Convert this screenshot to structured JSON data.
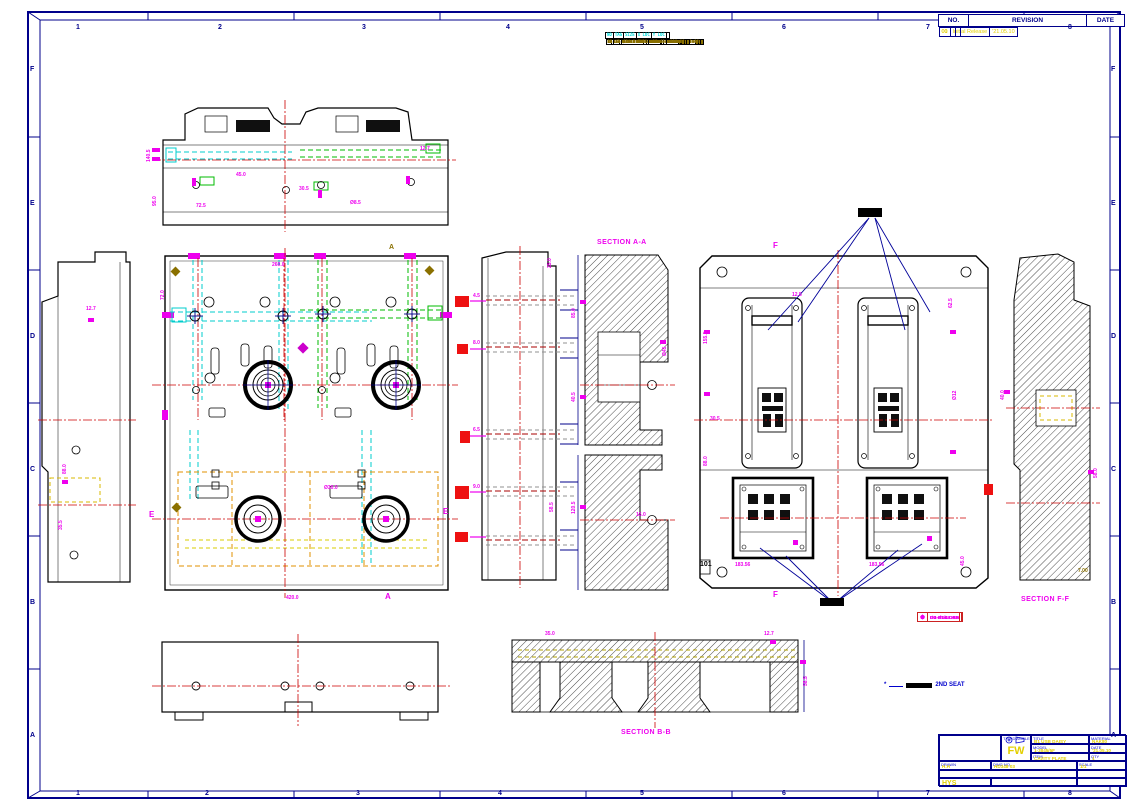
{
  "frame": {
    "top_numbers": [
      {
        "t": "1",
        "x": 76
      },
      {
        "t": "2",
        "x": 218
      },
      {
        "t": "3",
        "x": 362
      },
      {
        "t": "4",
        "x": 506
      },
      {
        "t": "5",
        "x": 640
      },
      {
        "t": "6",
        "x": 782
      },
      {
        "t": "7",
        "x": 926
      },
      {
        "t": "8",
        "x": 1068
      }
    ],
    "bottom_numbers": [
      {
        "t": "1",
        "x": 76
      },
      {
        "t": "2",
        "x": 205
      },
      {
        "t": "3",
        "x": 356
      },
      {
        "t": "4",
        "x": 498
      },
      {
        "t": "5",
        "x": 640
      },
      {
        "t": "6",
        "x": 782
      },
      {
        "t": "7",
        "x": 926
      },
      {
        "t": "8",
        "x": 1068
      }
    ],
    "side_letters": [
      {
        "t": "F",
        "y": 66
      },
      {
        "t": "E",
        "y": 200
      },
      {
        "t": "D",
        "y": 333
      },
      {
        "t": "C",
        "y": 466
      },
      {
        "t": "B",
        "y": 599
      },
      {
        "t": "A",
        "y": 732
      }
    ]
  },
  "hole_table": {
    "headers": [
      "NO",
      "TAG",
      "SIZE",
      "X LOC",
      "Y LOC"
    ],
    "rows": [
      {
        "c1": "1",
        "c2": "A1",
        "c3": "Ø8.5 THRU",
        "c4": "-172.04",
        "c5": "+45.47"
      },
      {
        "c1": "2",
        "c2": "A2",
        "c3": "Ø8.5 THRU",
        "c4": "-97.04",
        "c5": "+45.47"
      },
      {
        "c1": "3",
        "c2": "A3",
        "c3": "Ø8.5 THRU",
        "c4": "-22.04",
        "c5": "+45.47"
      },
      {
        "c1": "4",
        "c2": "A4",
        "c3": "Ø8.5 THRU",
        "c4": "+52.96",
        "c5": "+45.47"
      },
      {
        "c1": "5",
        "c2": "B1",
        "c3": "Ø6.8 DP18",
        "c4": "-160.50",
        "c5": "-22.40"
      },
      {
        "c1": "6",
        "c2": "B2",
        "c3": "Ø6.8 DP18",
        "c4": "-85.50",
        "c5": "-110.88"
      },
      {
        "c1": "7",
        "c2": "B3",
        "c3": "Ø6.8 DP18",
        "c4": "-10.50",
        "c5": "-22.40"
      },
      {
        "c1": "8",
        "c2": "B4",
        "c3": "Ø6.8 DP18",
        "c4": "+64.50",
        "c5": "-110.88"
      },
      {
        "c1": "9",
        "c2": "C1",
        "c3": "Ø10.2 THRU",
        "c4": "-143.00",
        "c5": "+4.12"
      },
      {
        "c1": "10",
        "c2": "C2",
        "c3": "Ø10.2 THRU",
        "c4": "-68.00",
        "c5": "+4.12"
      },
      {
        "c1": "11",
        "c2": "C3",
        "c3": "Ø12.0 DP25",
        "c4": "+7.00",
        "c5": "-64.00"
      },
      {
        "c1": "12",
        "c2": "C4",
        "c3": "Ø12.0 DP25",
        "c4": "+82.00",
        "c5": "-64.00"
      },
      {
        "c1": "13",
        "c2": "D1",
        "c3": "Ø5.1 THRU",
        "c4": "-131.26",
        "c5": "-35.50"
      },
      {
        "c1": "14",
        "c2": "D2",
        "c3": "M12X1.75-6H THRU",
        "c4": "-56.26",
        "c5": "-188.06"
      },
      {
        "c1": "15",
        "c2": "D3",
        "c3": "M12X1.75-6H THRU",
        "c4": "+18.74",
        "c5": "-188.06"
      },
      {
        "c1": "16",
        "c2": "E1",
        "c3": "M10X1.5-6H DP22",
        "c4": "-119.80",
        "c5": "+32.46"
      },
      {
        "c1": "17",
        "c2": "E2",
        "c3": "M10X1.5-6H DP22",
        "c4": "-44.80",
        "c5": "+32.46"
      },
      {
        "c1": "18",
        "c2": "E3",
        "c3": "M10X1.5-6H DP22",
        "c4": "+30.20",
        "c5": "-45.74"
      },
      {
        "c1": "19",
        "c2": "E4",
        "c3": "M10X1.5-6H DP22",
        "c4": "+105.20",
        "c5": "-45.74"
      },
      {
        "c1": "20",
        "c2": "F1",
        "c3": "M8X1.25-6H DP16",
        "c4": "-108.32",
        "c5": "+118.88"
      },
      {
        "c1": "21",
        "c2": "F2",
        "c3": "Ø4.2 DP12",
        "c4": "-33.32",
        "c5": "+54.12"
      },
      {
        "c1": "22",
        "c2": "F3",
        "c3": "Ø4.2 DP12",
        "c4": "+41.68",
        "c5": "+54.12"
      },
      {
        "c1": "23",
        "c2": "G1",
        "c3": "Ø3.5 THRU",
        "c4": "-96.88",
        "c5": "-12.50"
      },
      {
        "c1": "24",
        "c2": "G2",
        "c3": "Ø3.5 THRU",
        "c4": "-21.88",
        "c5": "-12.50"
      },
      {
        "c1": "25",
        "c2": "G3",
        "c3": "Ø3.5 THRU",
        "c4": "+53.12",
        "c5": "-76.24"
      },
      {
        "c1": "26",
        "c2": "H1",
        "c3": "Ø16.0 DP30",
        "c4": "-85.40",
        "c5": "+96.40"
      },
      {
        "c1": "27",
        "c2": "H2",
        "c3": "Ø16.0 DP30",
        "c4": "-10.40",
        "c5": "+96.40"
      },
      {
        "c1": "28",
        "c2": "H3",
        "c3": "Ø16.0 DP30",
        "c4": "+64.60",
        "c5": "-34.20"
      },
      {
        "c1": "29",
        "c2": "J1",
        "c3": "Ø7.0 DP15",
        "c4": "-73.96",
        "c5": "+75.06"
      },
      {
        "c1": "30",
        "c2": "J2",
        "c3": "Ø7.0 DP15",
        "c4": "+1.04",
        "c5": "+118.88"
      },
      {
        "c1": "31",
        "c2": "K1",
        "c3": "Ø20.0 THRU",
        "c4": "-62.52",
        "c5": "+118.88"
      },
      {
        "c1": "32",
        "c2": "K2",
        "c3": "Ø20.0 THRU",
        "c4": "+12.48",
        "c5": "+118.88"
      }
    ]
  },
  "revision": {
    "headers": {
      "no": "NO.",
      "rev": "REVISION",
      "date": "DATE"
    },
    "rows": [
      {
        "a": "00",
        "b": "Initial Release",
        "c": "'21.05.10"
      },
      {
        "a": "01",
        "b": "",
        "c": ""
      }
    ]
  },
  "title_block": {
    "third_angle": "THIRD ANGLE",
    "mark": "FW",
    "f1l": "TITLE",
    "f1v": "B1 USB DAISY",
    "f2l": "MATERIAL",
    "f2v": "NAK80",
    "f3l": "MODEL",
    "f3v": "1-3845/5F",
    "f4l": "DATE",
    "f4v": "'21.05.10",
    "f5l": "ITEM",
    "f5v": "CAVITY PLATE",
    "f6l": "QTY",
    "f6v": "1",
    "f7l": "DRAWN",
    "f7v": "H.H",
    "f8l": "DWG NO.",
    "f8v": "HD348-03",
    "f9l": "SCALE",
    "f9v": "1/1",
    "f10l": "FILE",
    "f10v": "20-043-5934/F-HD3-03",
    "f11l": "UNIT",
    "f11v": "mm",
    "f12v": "HYS",
    "f13l": "CHECKED",
    "f13v": "Y.S",
    "f14l": "SHEET",
    "f14v": "1/1"
  },
  "legend": {
    "items": [
      {
        "sym": "⊕",
        "txt": "Ø4-Ø7 EJ. PIN"
      },
      {
        "sym": "✛",
        "txt": "DB-Ø3/16 AIR"
      },
      {
        "sym": "⊗",
        "txt": "DB-Ø1/4 OIL"
      },
      {
        "sym": "⊙",
        "txt": "DB-Ø1/4 GAS"
      }
    ]
  },
  "note": {
    "star": "*",
    "text": "2ND SEAT"
  },
  "labels": {
    "section_aa": "SECTION A-A",
    "section_bb": "SECTION B-B",
    "section_ff": "SECTION F-F",
    "balloon": "101"
  },
  "annotations": [
    {
      "t": "140.5",
      "x": 146,
      "y": 162,
      "r": -90
    },
    {
      "t": "95.0",
      "x": 152,
      "y": 206,
      "r": -90
    },
    {
      "t": "45.0",
      "x": 236,
      "y": 172
    },
    {
      "t": "30.5",
      "x": 299,
      "y": 186
    },
    {
      "t": "72.5",
      "x": 196,
      "y": 203
    },
    {
      "t": "Ø8.5",
      "x": 350,
      "y": 200
    },
    {
      "t": "12.7",
      "x": 420,
      "y": 146
    },
    {
      "t": "35.5",
      "x": 58,
      "y": 530,
      "r": -90
    },
    {
      "t": "12.7",
      "x": 86,
      "y": 306
    },
    {
      "t": "88.0",
      "x": 62,
      "y": 474,
      "r": -90
    },
    {
      "t": "E",
      "x": 149,
      "y": 510,
      "fs": 8
    },
    {
      "t": "E",
      "x": 443,
      "y": 507,
      "fs": 8
    },
    {
      "t": "A",
      "x": 385,
      "y": 592,
      "fs": 8
    },
    {
      "t": "A",
      "x": 389,
      "y": 244,
      "fs": 7,
      "c": "#8a7000"
    },
    {
      "t": "Ø30.0",
      "x": 324,
      "y": 485
    },
    {
      "t": "260.0",
      "x": 272,
      "y": 262
    },
    {
      "t": "420.0",
      "x": 286,
      "y": 595
    },
    {
      "t": "72.0",
      "x": 160,
      "y": 300,
      "r": -90
    },
    {
      "t": "4.5",
      "x": 473,
      "y": 293
    },
    {
      "t": "8.0",
      "x": 473,
      "y": 340
    },
    {
      "t": "6.5",
      "x": 473,
      "y": 427
    },
    {
      "t": "9.0",
      "x": 473,
      "y": 484
    },
    {
      "t": "25.0",
      "x": 547,
      "y": 268,
      "r": -90
    },
    {
      "t": "58.5",
      "x": 549,
      "y": 512,
      "r": -90
    },
    {
      "t": "85.0",
      "x": 571,
      "y": 318,
      "r": -90
    },
    {
      "t": "40.5",
      "x": 571,
      "y": 402,
      "r": -90
    },
    {
      "t": "120.5",
      "x": 571,
      "y": 514,
      "r": -90
    },
    {
      "t": "Ø45",
      "x": 662,
      "y": 356,
      "r": -90
    },
    {
      "t": "16.0",
      "x": 636,
      "y": 512
    },
    {
      "t": "155.5",
      "x": 703,
      "y": 344,
      "r": -90
    },
    {
      "t": "88.0",
      "x": 703,
      "y": 466,
      "r": -90
    },
    {
      "t": "F",
      "x": 773,
      "y": 241,
      "fs": 8
    },
    {
      "t": "F",
      "x": 773,
      "y": 590,
      "fs": 8
    },
    {
      "t": "12.5",
      "x": 792,
      "y": 292
    },
    {
      "t": "62.5",
      "x": 948,
      "y": 308,
      "r": -90
    },
    {
      "t": "Ø12",
      "x": 952,
      "y": 400,
      "r": -90
    },
    {
      "t": "45.0",
      "x": 960,
      "y": 566,
      "r": -90
    },
    {
      "t": "183.56",
      "x": 735,
      "y": 562
    },
    {
      "t": "183.56",
      "x": 869,
      "y": 562
    },
    {
      "t": "30.5",
      "x": 710,
      "y": 416
    },
    {
      "t": "40.0",
      "x": 1000,
      "y": 400,
      "r": -90
    },
    {
      "t": "58.0",
      "x": 1093,
      "y": 478,
      "r": -90
    },
    {
      "t": "7.00",
      "x": 1078,
      "y": 568,
      "c": "#8a7000"
    },
    {
      "t": "58.5",
      "x": 803,
      "y": 686,
      "r": -90
    },
    {
      "t": "12.7",
      "x": 764,
      "y": 631
    },
    {
      "t": "35.0",
      "x": 545,
      "y": 631
    }
  ]
}
